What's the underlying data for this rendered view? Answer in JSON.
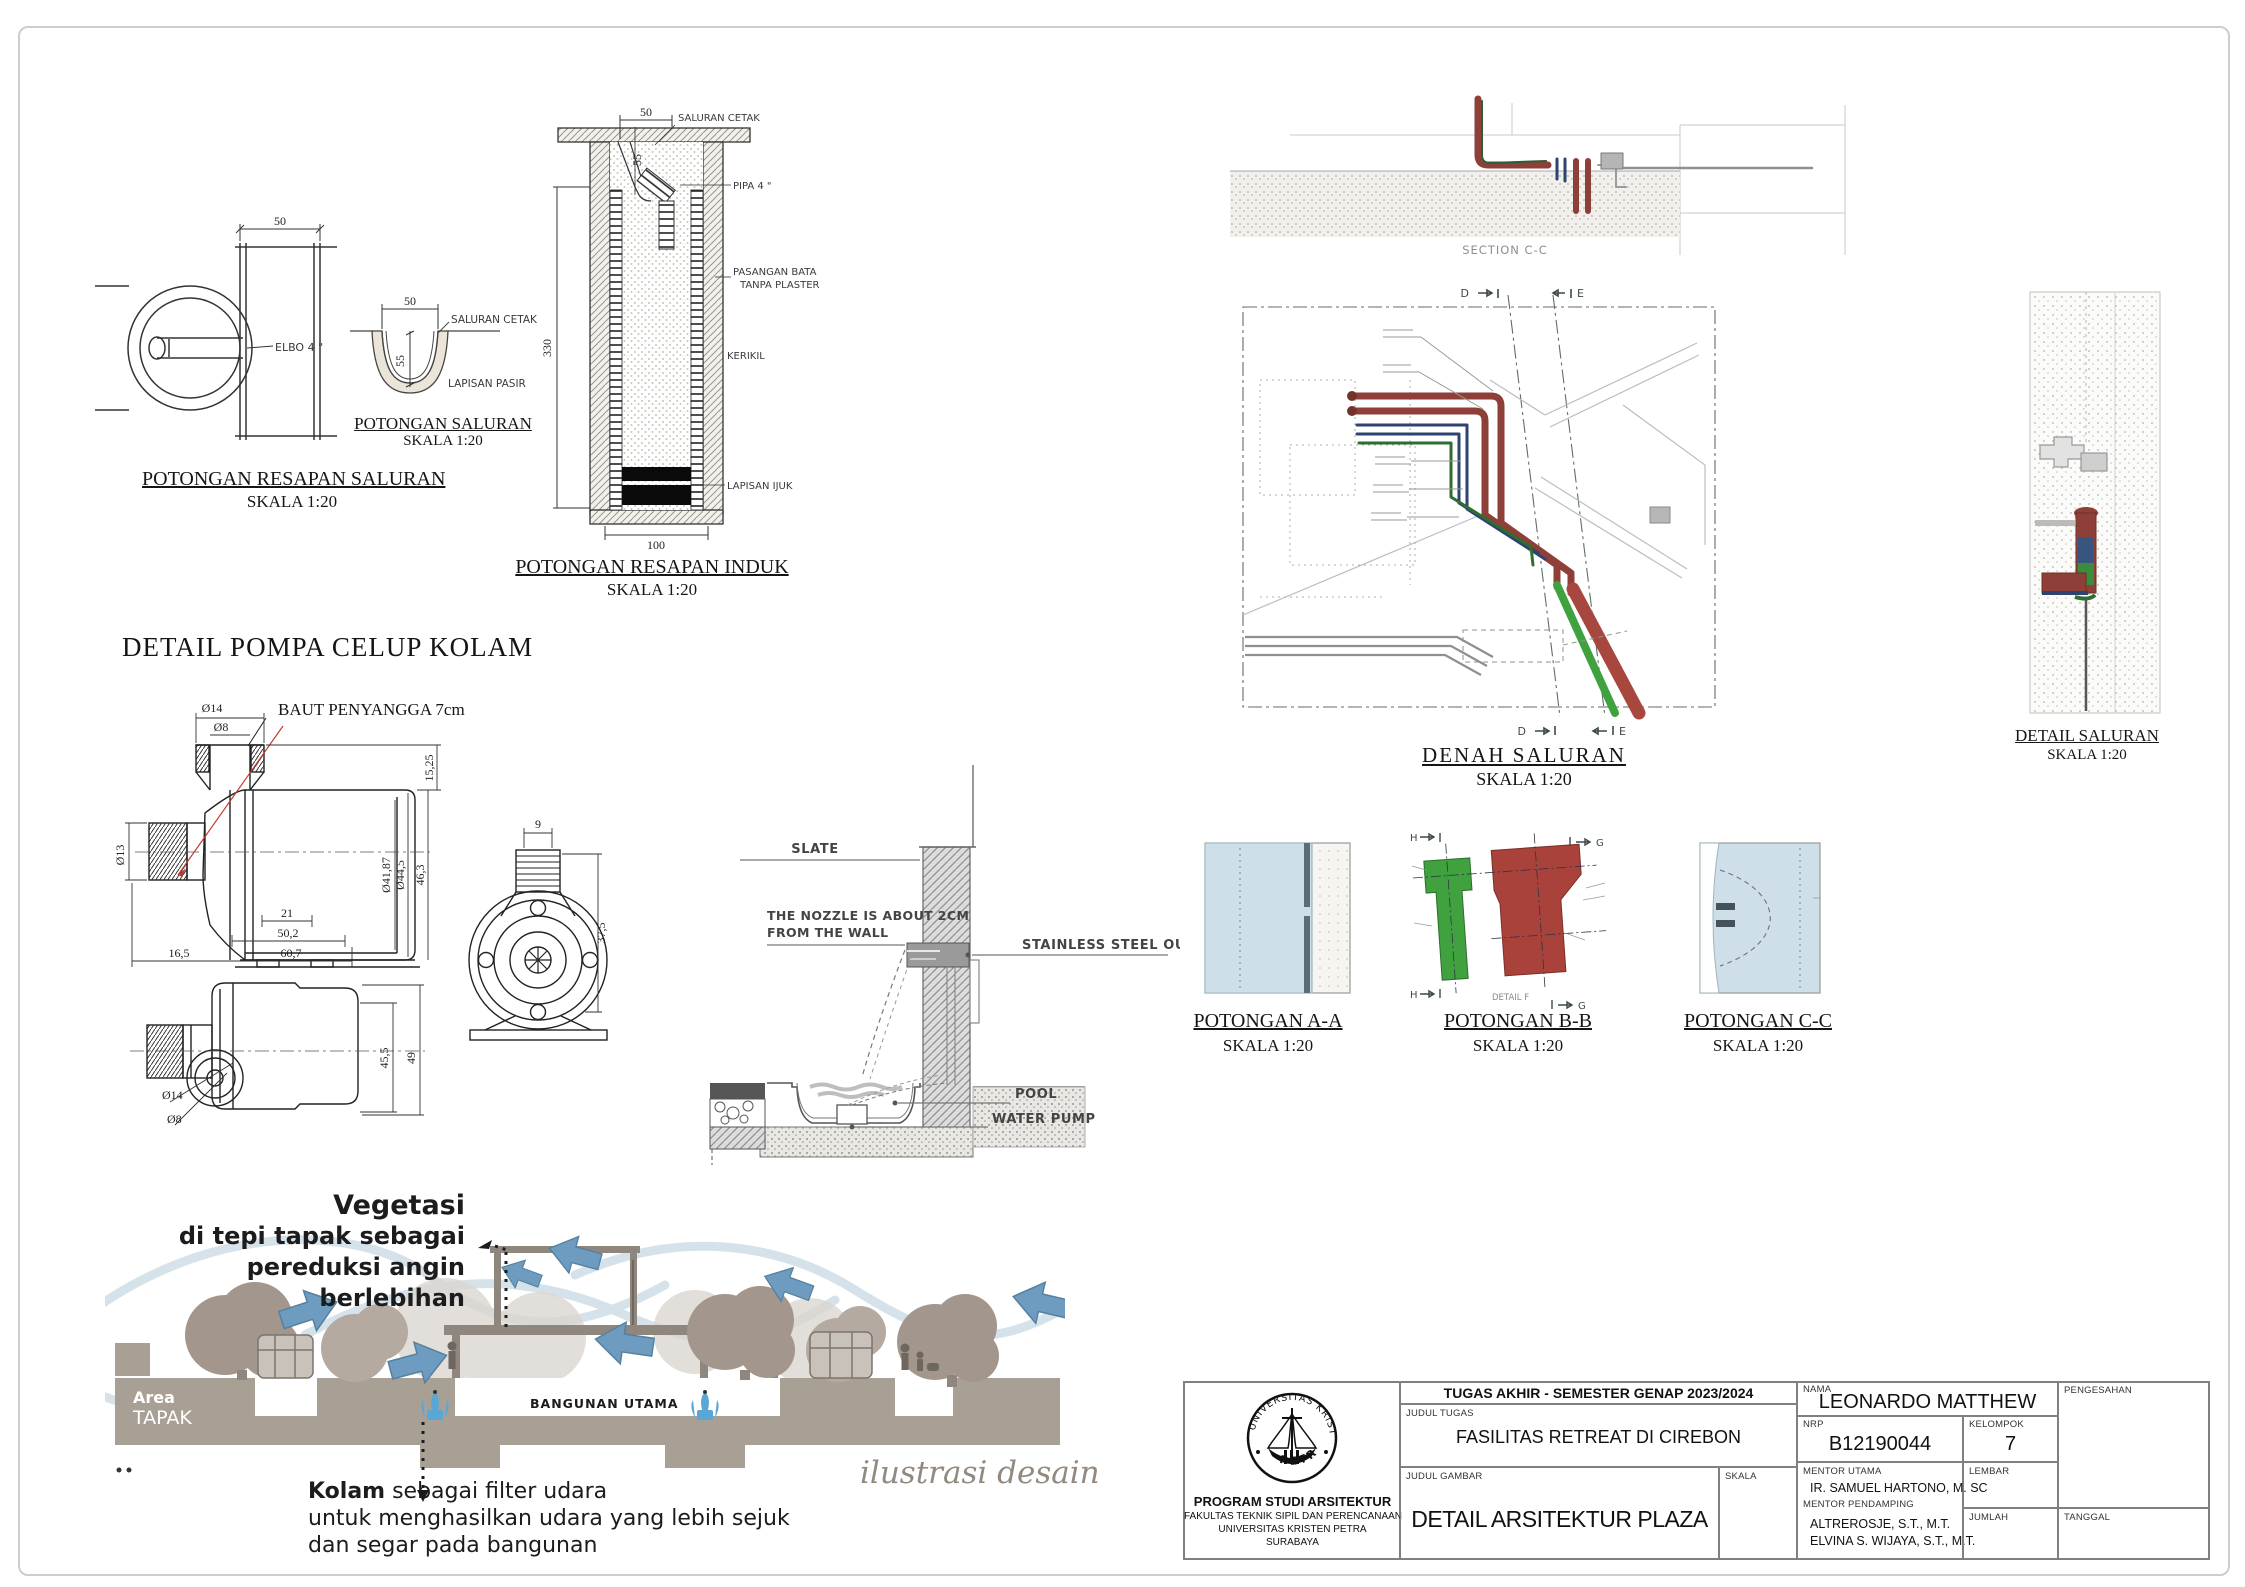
{
  "drawings": {
    "resapan_saluran": {
      "title": "POTONGAN RESAPAN SALURAN",
      "scale": "SKALA 1:20",
      "dim_width": "50",
      "label_elbow": "ELBO 4 \""
    },
    "saluran": {
      "title": "POTONGAN SALURAN",
      "scale": "SKALA 1:20",
      "dim_width": "50",
      "dim_depth": "55",
      "label_saluran_cetak": "SALURAN CETAK",
      "label_lapisan_pasir": "LAPISAN PASIR"
    },
    "resapan_induk": {
      "title": "POTONGAN RESAPAN INDUK",
      "scale": "SKALA 1:20",
      "dim_top": "50",
      "dim_funnel": "55",
      "dim_height": "330",
      "dim_width": "100",
      "label_saluran_cetak": "SALURAN CETAK",
      "label_pipa": "PIPA 4 \"",
      "label_bata_1": "PASANGAN BATA",
      "label_bata_2": "TANPA PLASTER",
      "label_kerikil": "KERIKIL",
      "label_ijuk": "LAPISAN IJUK"
    },
    "pompa": {
      "heading": "DETAIL POMPA CELUP KOLAM",
      "label_baut": "BAUT PENYANGGA 7cm",
      "side": {
        "d_top_outer": "Ø14",
        "d_top_inner": "Ø8",
        "d_left": "Ø13",
        "d_cap": "15,25",
        "d_body_inner": "Ø41,87",
        "d_body_outer": "Ø44,5",
        "d_height": "46,3",
        "d_feet": "21",
        "d_body_len": "50,2",
        "d_total_len": "60,7",
        "d_port": "16,5"
      },
      "front": {
        "d_stub": "9",
        "d_height": "37,5"
      },
      "bottom": {
        "d_body": "45,5",
        "d_total": "49",
        "d_eye_outer": "Ø14",
        "d_eye_inner": "Ø8"
      }
    },
    "slate": {
      "label_slate": "SLATE",
      "label_nozzle_1": "THE NOZZLE IS ABOUT 2CM",
      "label_nozzle_2": "FROM THE WALL",
      "label_outlet": "STAINLESS STEEL OUTLET",
      "label_pool": "POOL",
      "label_pump": "WATER PUMP"
    },
    "section_cc": {
      "caption": "SECTION C-C"
    },
    "denah": {
      "title": "DENAH SALURAN",
      "scale": "SKALA 1:20",
      "marker_d": "D",
      "marker_e": "E"
    },
    "detail_saluran": {
      "title": "DETAIL SALURAN",
      "scale": "SKALA 1:20"
    },
    "potongan_aa": {
      "title": "POTONGAN A-A",
      "scale": "SKALA 1:20"
    },
    "potongan_bb": {
      "title": "POTONGAN B-B",
      "scale": "SKALA 1:20",
      "marker_h": "H",
      "marker_g": "G",
      "caption": "DETAIL F"
    },
    "potongan_cc": {
      "title": "POTONGAN C-C",
      "scale": "SKALA 1:20"
    }
  },
  "illustration": {
    "veg_line1": "Vegetasi",
    "veg_line2": "di tepi tapak sebagai",
    "veg_line3": "pereduksi angin",
    "veg_line4": "berlebihan",
    "area_line1": "Area",
    "area_line2": "TAPAK",
    "bangunan": "BANGUNAN UTAMA",
    "kolam_bold": "Kolam",
    "kolam_rest": " sebagai filter udara",
    "kolam_line2": "untuk menghasilkan udara yang lebih sejuk",
    "kolam_line3": "dan segar pada bangunan",
    "caption": "ilustrasi desain"
  },
  "titleblock": {
    "header": "TUGAS AKHIR - SEMESTER GENAP 2023/2024",
    "labels": {
      "judul_tugas": "JUDUL TUGAS",
      "judul_gambar": "JUDUL GAMBAR",
      "skala": "SKALA",
      "nama": "NAMA",
      "nrp": "NRP",
      "kelompok": "KELOMPOK",
      "mentor_utama": "MENTOR UTAMA",
      "mentor_pendamping": "MENTOR PENDAMPING",
      "lembar": "LEMBAR",
      "jumlah": "JUMLAH",
      "pengesahan": "PENGESAHAN",
      "tanggal": "TANGGAL"
    },
    "values": {
      "judul_tugas": "FASILITAS RETREAT DI CIREBON",
      "judul_gambar": "DETAIL ARSITEKTUR PLAZA",
      "nama": "LEONARDO MATTHEW",
      "nrp": "B12190044",
      "kelompok": "7",
      "mentor_utama": "IR. SAMUEL HARTONO, M. SC",
      "mentor_pendamping_1": "ALTREROSJE, S.T., M.T.",
      "mentor_pendamping_2": "ELVINA S. WIJAYA, S.T., M.T."
    },
    "institution": {
      "line1": "PROGRAM STUDI ARSITEKTUR",
      "line2": "FAKULTAS TEKNIK SIPIL DAN PERENCANAAN",
      "line3": "UNIVERSITAS KRISTEN PETRA",
      "line4": "SURABAYA"
    },
    "logo": {
      "arc_top": "UNIVERSITAS KRISTEN",
      "arc_bottom": "PETRA"
    }
  },
  "colors": {
    "pipe_red": "#8e3f38",
    "pipe_blue": "#2e4372",
    "pipe_green": "#3d8b3d",
    "panel_blue": "#cedfe9",
    "arrow_blue": "#6d9cc0",
    "tree": "#a3968c",
    "ground": "#a9a095",
    "leader_red": "#c23b2e"
  }
}
